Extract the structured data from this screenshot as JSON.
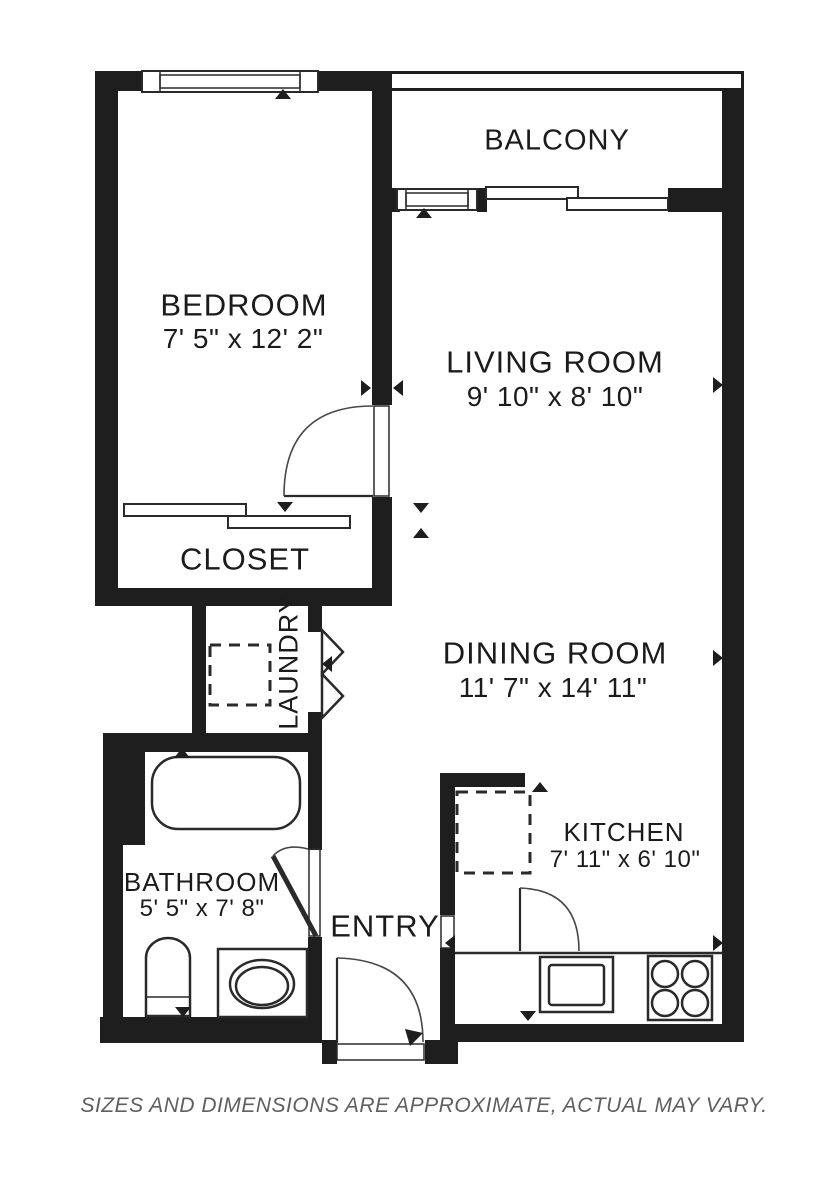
{
  "colors": {
    "wall-color": "#1e1e1e",
    "line-color": "#2a2a2a",
    "text-color": "#1b1b1b",
    "footer-color": "#5f5f5f"
  },
  "rooms": {
    "balcony": {
      "name": "BALCONY"
    },
    "bedroom": {
      "name": "BEDROOM",
      "dims": "7' 5\" x 12' 2\""
    },
    "living": {
      "name": "LIVING ROOM",
      "dims": "9' 10\" x 8' 10\""
    },
    "closet": {
      "name": "CLOSET"
    },
    "laundry": {
      "name": "LAUNDRY"
    },
    "dining": {
      "name": "DINING ROOM",
      "dims": "11' 7\" x 14' 11\""
    },
    "bathroom": {
      "name": "BATHROOM",
      "dims": "5' 5\" x 7' 8\""
    },
    "entry": {
      "name": "ENTRY"
    },
    "kitchen": {
      "name": "KITCHEN",
      "dims": "7' 11\" x 6' 10\""
    }
  },
  "footer": {
    "disclaimer": "SIZES AND DIMENSIONS ARE APPROXIMATE, ACTUAL MAY VARY."
  }
}
